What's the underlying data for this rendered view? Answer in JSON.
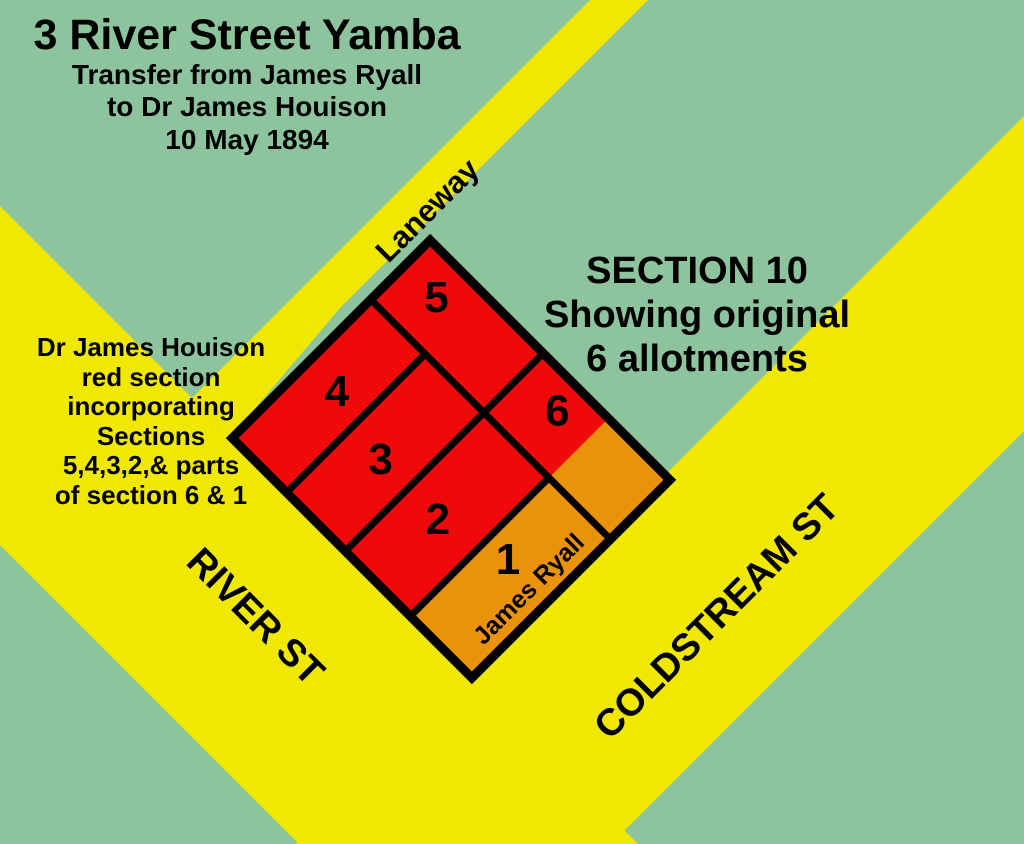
{
  "title": {
    "main": "3 River Street Yamba",
    "sub1": "Transfer from James Ryall",
    "sub2": "to Dr James Houison",
    "sub3": "10 May 1894"
  },
  "section_note": {
    "lines": [
      "SECTION 10",
      "Showing original",
      "6 allotments"
    ]
  },
  "houison_note": {
    "lines": [
      "Dr James Houison",
      "red section",
      "incorporating",
      "Sections",
      "5,4,3,2,& parts",
      "of section 6 & 1"
    ]
  },
  "streets": {
    "laneway": "Laneway",
    "river_st": "RIVER ST",
    "coldstream_st": "COLDSTREAM ST"
  },
  "allotments": {
    "numbers": [
      "1",
      "2",
      "3",
      "4",
      "5",
      "6"
    ],
    "owner_label": "James Ryall"
  },
  "colors": {
    "background_green": "#8dc49e",
    "road_yellow": "#f0e800",
    "houison_red": "#ee0a0a",
    "ryall_orange": "#e9920a",
    "line_black": "#000000"
  }
}
